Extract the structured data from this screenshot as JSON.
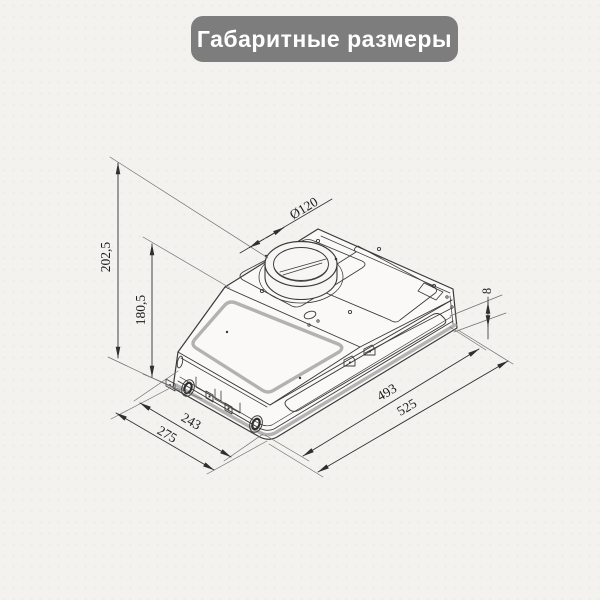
{
  "header": {
    "title": "Габаритные размеры"
  },
  "drawing": {
    "subject": "built-in cooker hood overall dimensions, isometric view",
    "labels": {
      "duct_diameter": "Ø120",
      "height_total": "202,5",
      "height_body": "180,5",
      "flange_height": "8",
      "length_inner": "493",
      "length_outer": "525",
      "depth_inner": "243",
      "depth_outer": "275"
    },
    "colors": {
      "header_bg": "#7d7d7d",
      "header_text": "#ffffff",
      "paper": "#f3f2ef",
      "line": "#3a3a3a",
      "seam_gray": "#b3b3b3",
      "dimension_line": "#2f2f2f"
    }
  }
}
